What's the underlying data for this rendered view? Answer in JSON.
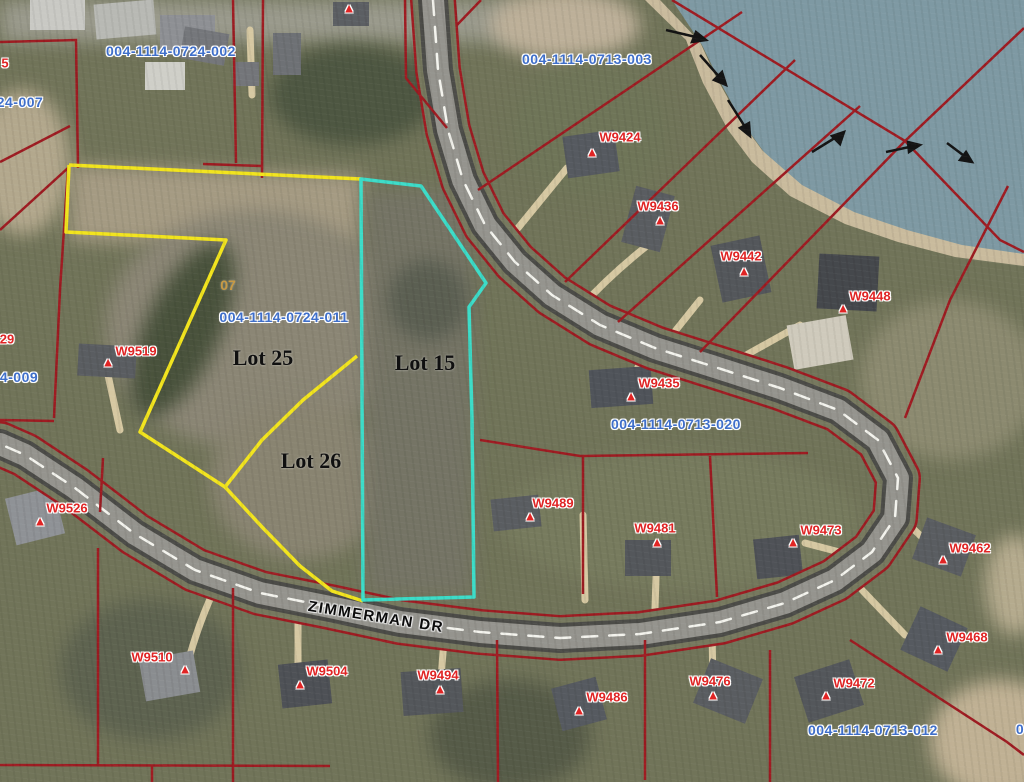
{
  "road": {
    "name": "ZIMMERMAN DR"
  },
  "colors": {
    "boundary_yellow": "#f2e41e",
    "boundary_cyan": "#3cdcc8",
    "parcel_line_red": "#9e1c22",
    "parcel_id_blue": "#3f6fca",
    "marker_red": "#e02424",
    "lake": "#7e99a3",
    "road_gray": "#95948e"
  },
  "lots": [
    {
      "label": "Lot 25",
      "x": 263,
      "y": 358
    },
    {
      "label": "Lot 26",
      "x": 311,
      "y": 461
    },
    {
      "label": "Lot 15",
      "x": 425,
      "y": 363
    }
  ],
  "section_marker": {
    "label": "07",
    "x": 228,
    "y": 285
  },
  "parcel_ids": [
    {
      "label": "004-1114-0724-002",
      "x": 171,
      "y": 51
    },
    {
      "label": "004-1114-0713-003",
      "x": 587,
      "y": 59
    },
    {
      "label": "004-1114-0724-011",
      "x": 284,
      "y": 317
    },
    {
      "label": "004-1114-0713-020",
      "x": 676,
      "y": 424
    },
    {
      "label": "004-1114-0713-012",
      "x": 873,
      "y": 730
    }
  ],
  "partial_edge_labels": [
    {
      "label": "5",
      "x": 5,
      "y": 63,
      "color": "red"
    },
    {
      "label": "24-007",
      "x": 20,
      "y": 102,
      "color": "blue"
    },
    {
      "label": "29",
      "x": 7,
      "y": 339,
      "color": "red"
    },
    {
      "label": "4-009",
      "x": 19,
      "y": 377,
      "color": "blue"
    },
    {
      "label": "0",
      "x": 1020,
      "y": 729,
      "color": "blue"
    }
  ],
  "address_markers": [
    {
      "label": "W9424",
      "x": 620,
      "y": 137,
      "tx": 592,
      "ty": 152
    },
    {
      "label": "W9436",
      "x": 658,
      "y": 206,
      "tx": 660,
      "ty": 220
    },
    {
      "label": "W9442",
      "x": 741,
      "y": 256,
      "tx": 744,
      "ty": 271
    },
    {
      "label": "W9448",
      "x": 870,
      "y": 296,
      "tx": 843,
      "ty": 308
    },
    {
      "label": "W9435",
      "x": 659,
      "y": 383,
      "tx": 631,
      "ty": 396
    },
    {
      "label": "W9519",
      "x": 136,
      "y": 351,
      "tx": 108,
      "ty": 362
    },
    {
      "label": "W9526",
      "x": 67,
      "y": 508,
      "tx": 40,
      "ty": 521
    },
    {
      "label": "W9489",
      "x": 553,
      "y": 503,
      "tx": 530,
      "ty": 516
    },
    {
      "label": "W9481",
      "x": 655,
      "y": 528,
      "tx": 657,
      "ty": 542
    },
    {
      "label": "W9473",
      "x": 821,
      "y": 530,
      "tx": 793,
      "ty": 542
    },
    {
      "label": "W9462",
      "x": 970,
      "y": 548,
      "tx": 943,
      "ty": 559
    },
    {
      "label": "W9468",
      "x": 967,
      "y": 637,
      "tx": 938,
      "ty": 649
    },
    {
      "label": "W9472",
      "x": 854,
      "y": 683,
      "tx": 826,
      "ty": 695
    },
    {
      "label": "W9510",
      "x": 152,
      "y": 657,
      "tx": 185,
      "ty": 669
    },
    {
      "label": "W9504",
      "x": 327,
      "y": 671,
      "tx": 300,
      "ty": 684
    },
    {
      "label": "W9494",
      "x": 438,
      "y": 675,
      "tx": 440,
      "ty": 689
    },
    {
      "label": "W9486",
      "x": 607,
      "y": 697,
      "tx": 579,
      "ty": 710
    },
    {
      "label": "W9476",
      "x": 710,
      "y": 681,
      "tx": 713,
      "ty": 695
    }
  ],
  "unlabeled_markers": [
    {
      "x": 349,
      "y": 8
    }
  ]
}
